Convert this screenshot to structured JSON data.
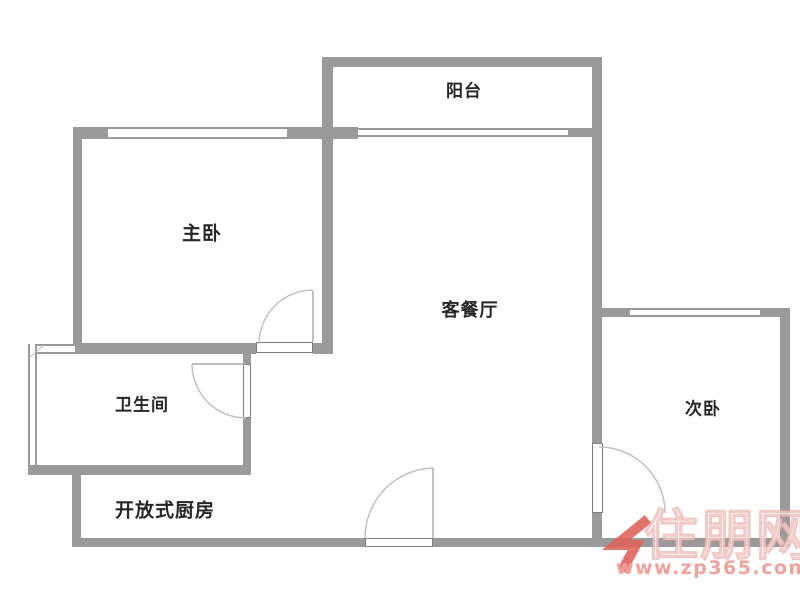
{
  "floorplan": {
    "rooms": [
      {
        "id": "balcony",
        "label": "阳台"
      },
      {
        "id": "master-bedroom",
        "label": "主卧"
      },
      {
        "id": "living-dining",
        "label": "客餐厅"
      },
      {
        "id": "bathroom",
        "label": "卫生间"
      },
      {
        "id": "open-kitchen",
        "label": "开放式厨房"
      },
      {
        "id": "second-bedroom",
        "label": "次卧"
      }
    ],
    "colors": {
      "wall_gray": "#9a9a9a",
      "label_text": "#262626",
      "door_arc": "#c0c0c0"
    }
  },
  "watermark": {
    "site_name": "住朋网",
    "site_url": "www.zp365.com",
    "logo": "zp365-arrow-logo",
    "colors": {
      "logo_red": "#e0605a",
      "url_pink": "#ec827a"
    }
  }
}
